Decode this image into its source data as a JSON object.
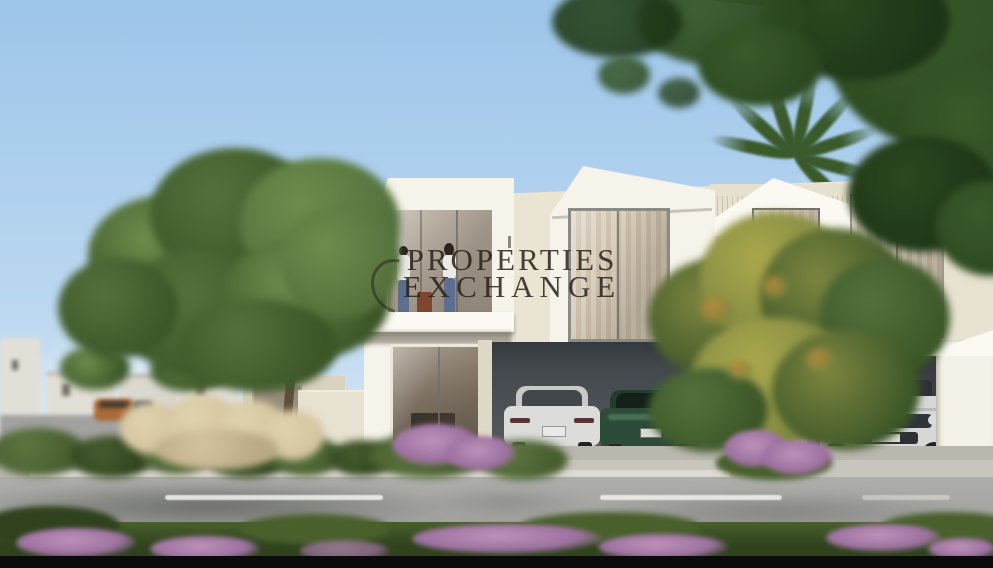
{
  "watermark": {
    "line1": "PROPERTIES",
    "line2": "EXCHANGE"
  },
  "colors": {
    "sky_top": "#9dc5ea",
    "sky_mid": "#bcd8f0",
    "sky_bottom": "#d9e8f4",
    "wall_white": "#f6f3ea",
    "wall_cream": "#eae5d3",
    "wall_shadow": "#d8d2c0",
    "roof_white": "#fbf9f1",
    "slat_base": "#e6e0ce",
    "carport": "#42484c",
    "carport_light": "#5a6064",
    "glass": "#b3a99c",
    "glass_dark": "#75695c",
    "curtain_a": "#e2d7c4",
    "curtain_b": "#cfc2ac",
    "mullion": "#73716c",
    "road": "#9c9c9a",
    "road_light": "#aeaeab",
    "sidewalk": "#bab7af",
    "curb": "#dcdad2",
    "driveway": "#c8c5bc",
    "grass_dark": "#2f421d",
    "grass_mid": "#49602c",
    "bush": "#465c2e",
    "bush_light": "#5d7540",
    "pampas": "#d3c49f",
    "pampas_light": "#e0d2ae",
    "tree_green": "#54713c",
    "tree_green_dark": "#3c5628",
    "tree_green_light": "#6e8c4c",
    "canopy_dark": "#2b481f",
    "canopy_mid": "#3a5a2a",
    "tree_yellow": "#aaa84e",
    "tree_olive": "#7c853f",
    "tree_orange": "#bf8a3c",
    "trunk": "#5f4e3b",
    "trunk_light": "#c9baa2",
    "trunk_dark": "#352a1d",
    "palm": "#3a5a2c",
    "flower": "#9d71a0",
    "flower_light": "#bd92ba",
    "car_white": "#dcdcda",
    "car_white_dark": "#c9c9c7",
    "car_green": "#2c4b39",
    "car_green_light": "#4a7258",
    "car_window": "#42474b",
    "suv_white": "#d5d8d6",
    "suv_dark": "#2c3136",
    "tire": "#222426",
    "distant_house": "#e2dfd7",
    "street": "#a3a2a0",
    "people_shirt": "#eceae6",
    "people_jeans": "#5c6f8e",
    "people_hair": "#2c241d",
    "pot": "#7e452f",
    "watermark": "rgba(40,33,26,0.85)",
    "black_bar": "#0b0b0c"
  }
}
